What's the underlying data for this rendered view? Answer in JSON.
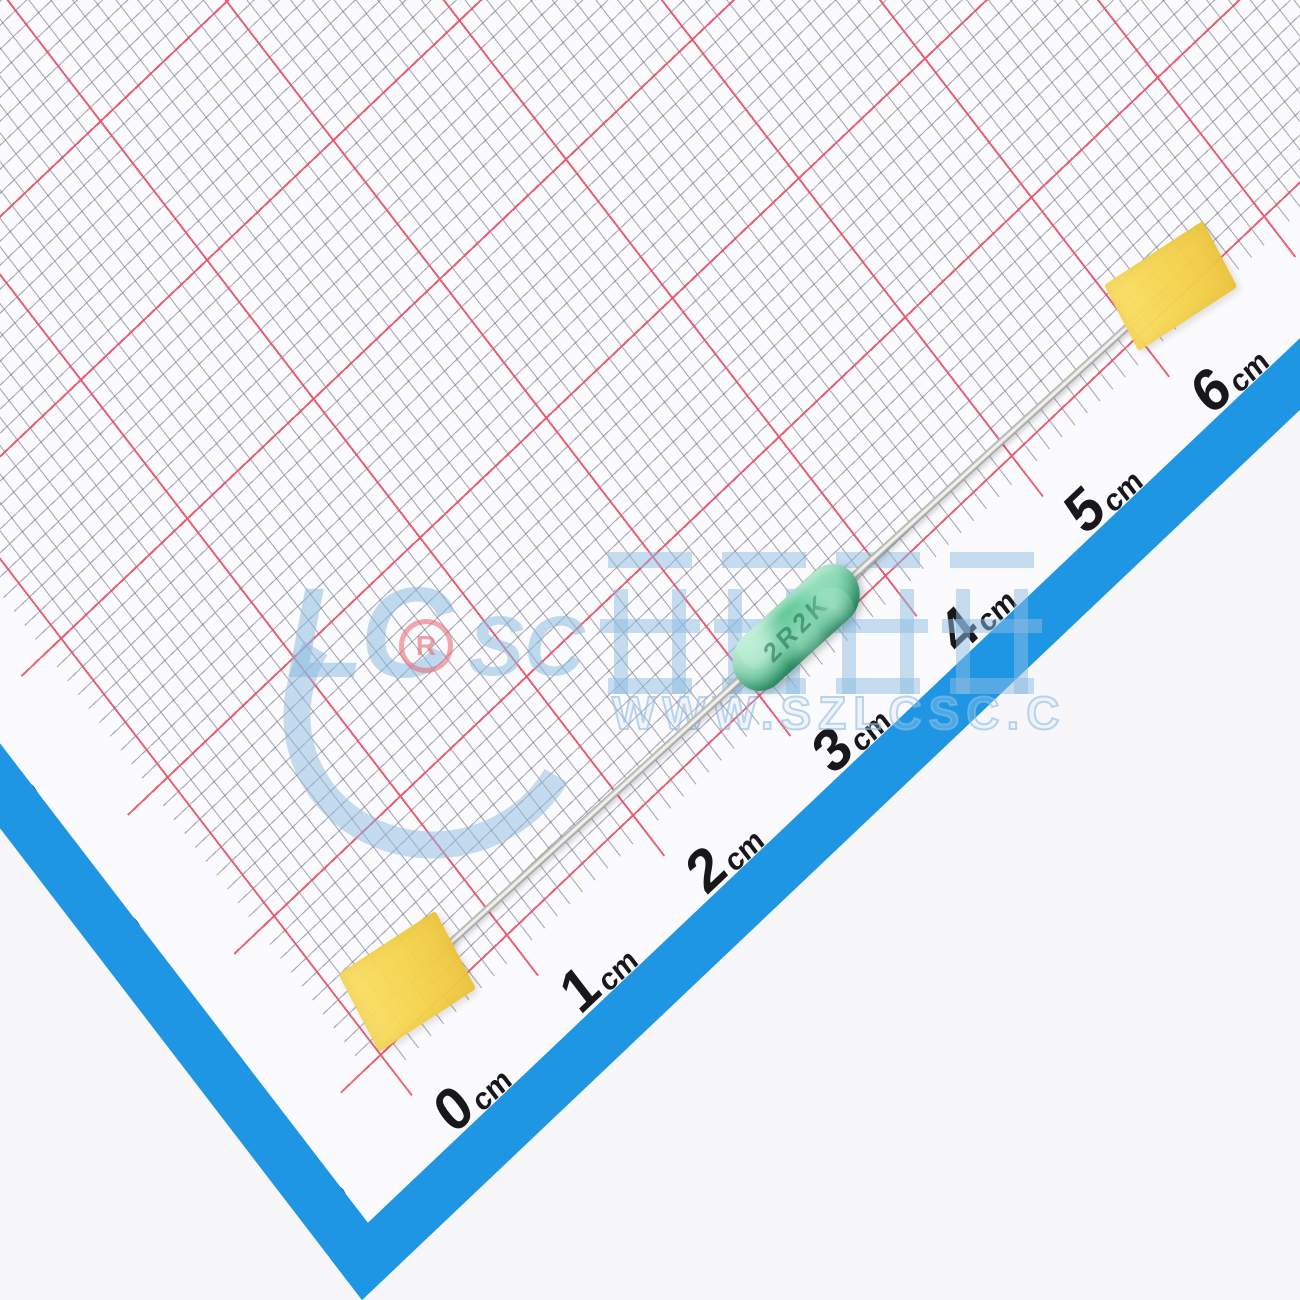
{
  "rulers": {
    "bottom": {
      "unit": "cm",
      "labels": [
        "0",
        "1",
        "2",
        "3",
        "4",
        "5",
        "6",
        "7"
      ]
    },
    "left": {
      "unit": "cm",
      "labels": [
        "0",
        "1",
        "2",
        "3"
      ]
    }
  },
  "watermark": {
    "logo_left": "LC",
    "logo_right": "SC",
    "registered_mark": "R",
    "cjk_text": "立创商城",
    "url_text": "WWW.SZLCSC.C"
  },
  "component": {
    "marking": "2R2K",
    "body_color": "#55c08e",
    "lead_color": "#e8e8e4",
    "tape_color": "#f5d44d"
  },
  "colors": {
    "band_blue": "#1e96e3",
    "grid_red": "#ea5168",
    "grid_gray": "#64667a",
    "paper": "#fbfafd",
    "background": "#f7f7fa"
  }
}
